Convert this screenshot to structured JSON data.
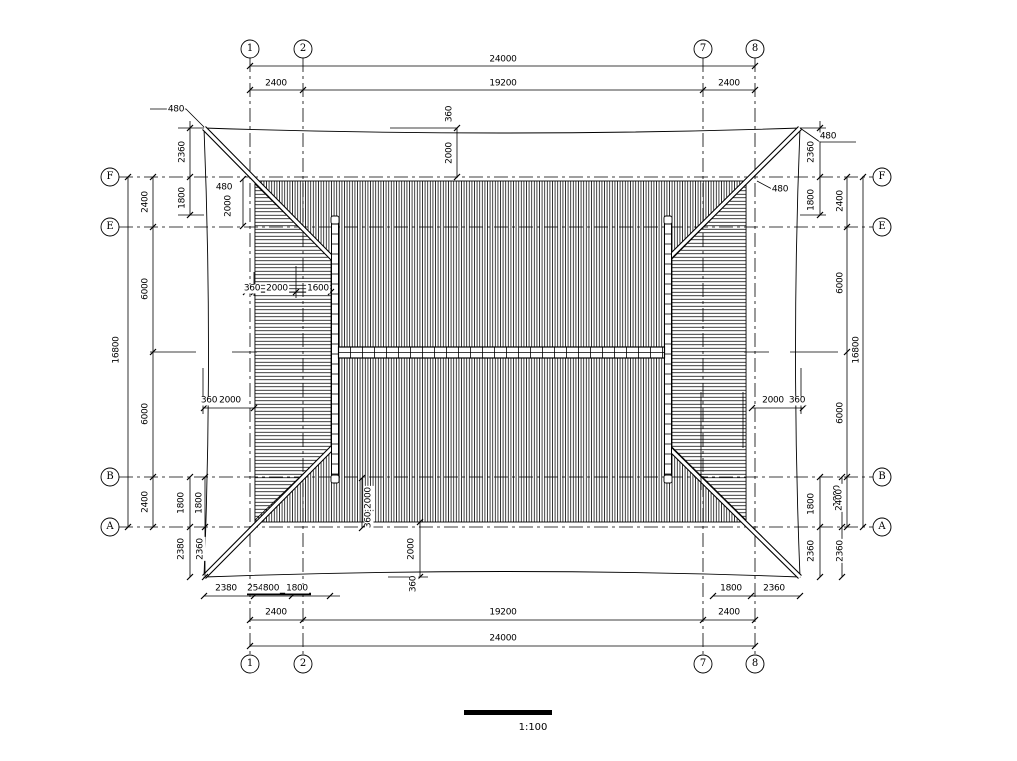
{
  "drawing": {
    "type": "roof-plan",
    "scale_label": "1:100"
  },
  "grid": {
    "columns": [
      "1",
      "2",
      "7",
      "8"
    ],
    "rows": [
      "F",
      "E",
      "B",
      "A"
    ]
  },
  "dimensions": {
    "overall_width": "24000",
    "overall_height": "16800",
    "main_bay": "19200",
    "side_bay": "2400",
    "row_bays": [
      "2400",
      "6000",
      "6000",
      "2400"
    ],
    "eave_overhang": "2360",
    "eave_tip": "480"
  },
  "labels": [
    {
      "t": "24000",
      "x": 503,
      "y": 60
    },
    {
      "t": "2400",
      "x": 276,
      "y": 84
    },
    {
      "t": "19200",
      "x": 503,
      "y": 84
    },
    {
      "t": "2400",
      "x": 729,
      "y": 84
    },
    {
      "t": "480",
      "x": 176,
      "y": 110
    },
    {
      "t": "2360",
      "x": 183,
      "y": 152,
      "r": -90
    },
    {
      "t": "1800",
      "x": 183,
      "y": 198,
      "r": -90
    },
    {
      "t": "480",
      "x": 224,
      "y": 188
    },
    {
      "t": "2000",
      "x": 229,
      "y": 206,
      "r": -90
    },
    {
      "t": "2400",
      "x": 146,
      "y": 202,
      "r": -90
    },
    {
      "t": "6000",
      "x": 146,
      "y": 289,
      "r": -90
    },
    {
      "t": "6000",
      "x": 146,
      "y": 414,
      "r": -90
    },
    {
      "t": "2400",
      "x": 146,
      "y": 502,
      "r": -90
    },
    {
      "t": "16800",
      "x": 117,
      "y": 350,
      "r": -90
    },
    {
      "t": "360",
      "x": 252,
      "y": 289
    },
    {
      "t": "2000",
      "x": 277,
      "y": 289
    },
    {
      "t": "1600",
      "x": 318,
      "y": 289
    },
    {
      "t": "360",
      "x": 209,
      "y": 401
    },
    {
      "t": "2000",
      "x": 230,
      "y": 401
    },
    {
      "t": "1800",
      "x": 182,
      "y": 503,
      "r": -90
    },
    {
      "t": "1800",
      "x": 200,
      "y": 503,
      "r": -90
    },
    {
      "t": "2380",
      "x": 182,
      "y": 549,
      "r": -90
    },
    {
      "t": "2360",
      "x": 201,
      "y": 549,
      "r": -90
    },
    {
      "t": "360",
      "x": 450,
      "y": 114,
      "r": -90
    },
    {
      "t": "2000",
      "x": 450,
      "y": 153,
      "r": -90
    },
    {
      "t": "2000",
      "x": 369,
      "y": 498,
      "r": -90
    },
    {
      "t": "360",
      "x": 369,
      "y": 520,
      "r": -90
    },
    {
      "t": "2000",
      "x": 412,
      "y": 549,
      "r": -90
    },
    {
      "t": "360",
      "x": 414,
      "y": 584,
      "r": -90
    },
    {
      "t": "480",
      "x": 828,
      "y": 137
    },
    {
      "t": "2360",
      "x": 812,
      "y": 152,
      "r": -90
    },
    {
      "t": "480",
      "x": 780,
      "y": 190
    },
    {
      "t": "1800",
      "x": 812,
      "y": 200,
      "r": -90
    },
    {
      "t": "2400",
      "x": 841,
      "y": 201,
      "r": -90
    },
    {
      "t": "6000",
      "x": 841,
      "y": 283,
      "r": -90
    },
    {
      "t": "6000",
      "x": 841,
      "y": 413,
      "r": -90
    },
    {
      "t": "16800",
      "x": 857,
      "y": 350,
      "r": -90
    },
    {
      "t": "2000",
      "x": 773,
      "y": 401
    },
    {
      "t": "360",
      "x": 797,
      "y": 401
    },
    {
      "t": "1800",
      "x": 812,
      "y": 504,
      "r": -90
    },
    {
      "t": "2360",
      "x": 812,
      "y": 551,
      "r": -90
    },
    {
      "t": "1800",
      "x": 838,
      "y": 496,
      "r": -90
    },
    {
      "t": "2400",
      "x": 840,
      "y": 500,
      "r": -90
    },
    {
      "t": "2360",
      "x": 841,
      "y": 551,
      "r": -90
    },
    {
      "t": "2380",
      "x": 226,
      "y": 589
    },
    {
      "t": "2540",
      "x": 258,
      "y": 589
    },
    {
      "t": "800",
      "x": 271,
      "y": 589
    },
    {
      "t": "1800",
      "x": 297,
      "y": 589
    },
    {
      "t": "1800",
      "x": 731,
      "y": 589
    },
    {
      "t": "2360",
      "x": 774,
      "y": 589
    },
    {
      "t": "2400",
      "x": 276,
      "y": 613
    },
    {
      "t": "19200",
      "x": 503,
      "y": 613
    },
    {
      "t": "2400",
      "x": 729,
      "y": 613
    },
    {
      "t": "24000",
      "x": 503,
      "y": 639
    }
  ]
}
